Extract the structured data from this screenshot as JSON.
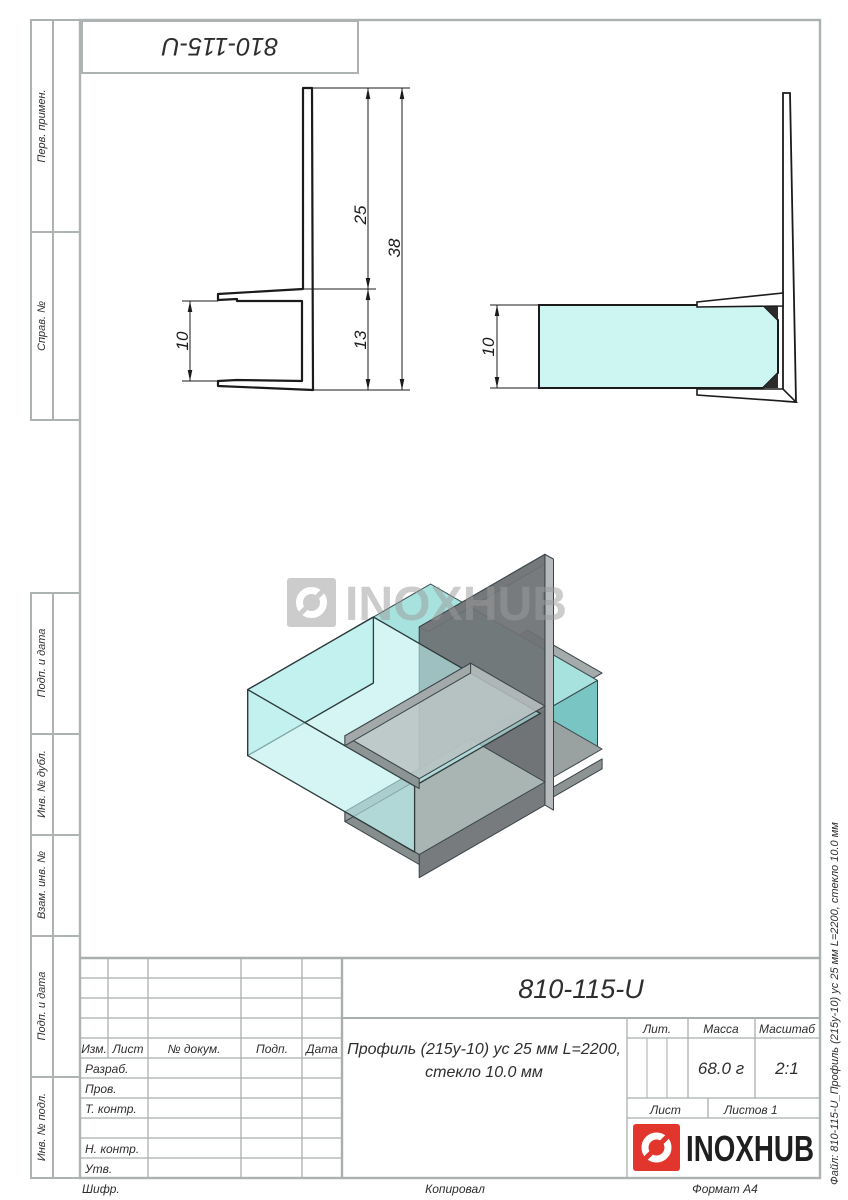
{
  "sheet": {
    "top_designation": "810-115-U",
    "file_note": "Файл: 810-115-U_Профиль (215у-10) ус 25 мм L=2200, стекло 10.0 мм",
    "footer": {
      "cipher": "Шифр.",
      "copied": "Копировал",
      "format": "Формат А4"
    }
  },
  "margin_labels": [
    "Перв. примен.",
    "Справ. №",
    "Подп. и дата",
    "Инв. № дубл.",
    "Взам. инв. №",
    "Подп. и дата",
    "Инв. № подл."
  ],
  "brand": {
    "name": "INOXHUB",
    "logo_red": "#e2352b"
  },
  "watermark": {
    "text": "INOXHUB"
  },
  "views": {
    "front": {
      "dim_upper_leg": "25",
      "dim_total_height": "38",
      "dim_channel_depth": "13",
      "dim_opening": "10"
    },
    "side": {
      "dim_glass_thickness": "10"
    }
  },
  "title_block": {
    "designation": "810-115-U",
    "name_line1": "Профиль (215у-10) ус 25 мм L=2200,",
    "name_line2": "стекло 10.0 мм",
    "columns": {
      "izm": "Изм.",
      "list": "Лист",
      "dokum": "№ докум.",
      "podp": "Подп.",
      "data": "Дата"
    },
    "rows": {
      "razrab": "Разраб.",
      "prov": "Пров.",
      "t_kontr": "Т. контр.",
      "n_kontr": "Н. контр.",
      "utv": "Утв."
    },
    "lit_label": "Лит.",
    "massa_label": "Масса",
    "masshtab_label": "Масштаб",
    "massa_value": "68.0 г",
    "masshtab_value": "2:1",
    "list_label": "Лист",
    "listov_label": "Листов 1"
  }
}
